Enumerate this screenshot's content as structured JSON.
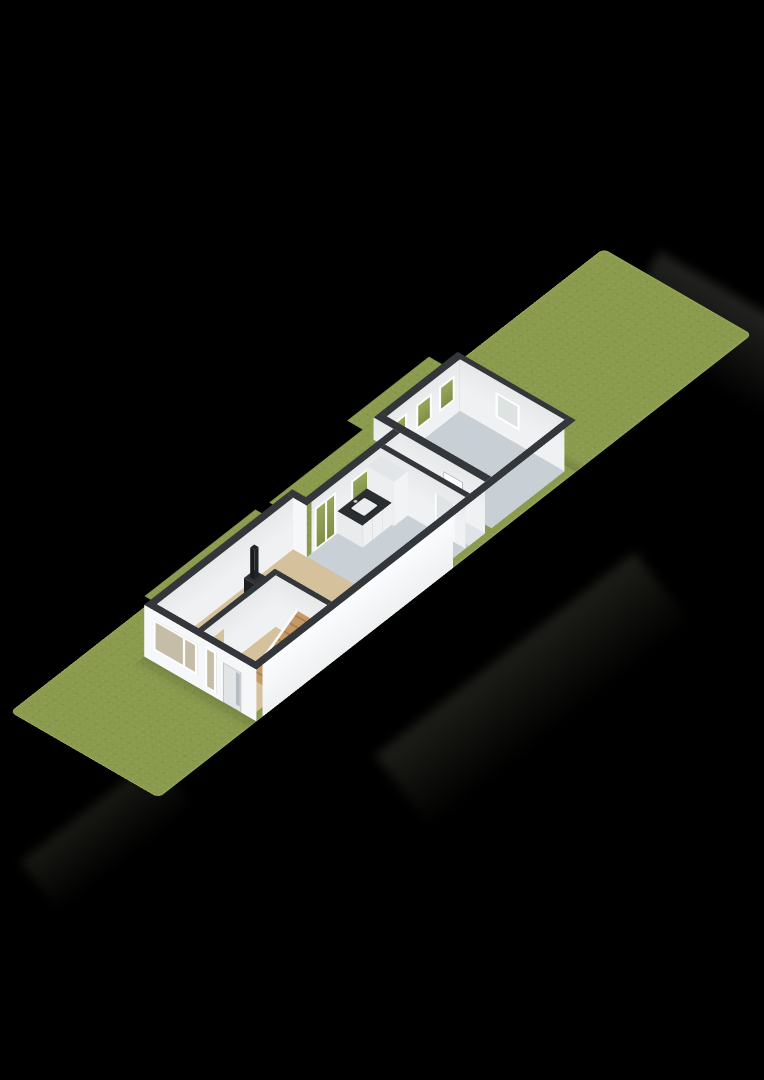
{
  "scene": {
    "type": "3d-floorplan-isometric",
    "background_color": "#000000",
    "parcel": {
      "description": "long narrow grass lot shown diagonally from lower-left to upper-right",
      "grass_color": "#8a9b4d"
    },
    "buildings": [
      {
        "name": "main-house",
        "wall_top_color": "#33363a",
        "rooms": [
          {
            "name": "living-room",
            "floor_color": "#d5c19c",
            "fixtures": [
              "wood-stove-with-flue"
            ]
          },
          {
            "name": "hallway",
            "floor_color": "#d5c19c",
            "fixtures": [
              "staircase",
              "open-interior-door"
            ]
          },
          {
            "name": "kitchen",
            "floor_color": "#c9d1d6",
            "fixtures": [
              "counter-with-sink",
              "tall-cabinet"
            ],
            "openings": [
              "french-doors",
              "window-above-sink"
            ]
          },
          {
            "name": "bathroom",
            "floor_color": "#e1e4e6",
            "fixtures": [
              "toilet"
            ],
            "openings": [
              "door-to-kitchen",
              "door-in-rear-wall"
            ]
          }
        ],
        "front_facade_openings": [
          "large-window",
          "tall-narrow-window",
          "front-door-with-sidelight"
        ]
      },
      {
        "name": "rear-building",
        "wall_top_color": "#33363a",
        "rooms": [
          {
            "name": "storage-room",
            "floor_color": "#c8d0d5",
            "openings": [
              "side-window-1",
              "side-window-2",
              "side-window-3",
              "rear-window"
            ]
          }
        ]
      }
    ]
  },
  "palette": {
    "lawn": "#8a9b4d",
    "walltop": "#33363a",
    "wall": "#f6f7f8",
    "wallin": "#f0f1f2",
    "floorliving": "#d5c19c",
    "floorkitchen": "#c9d1d6",
    "floorrear": "#c8d0d5",
    "floorbath": "#e1e4e6",
    "glassgreen": "#8a9b4f",
    "glassint": "#c6bda9",
    "countertop": "#2b2e31",
    "cabinet": "#f1f3f4",
    "stove": "#232527",
    "fire": "#e0914a",
    "stairwood": "#c49a66",
    "doorface": "#e2e4e6",
    "background": "#000000"
  }
}
